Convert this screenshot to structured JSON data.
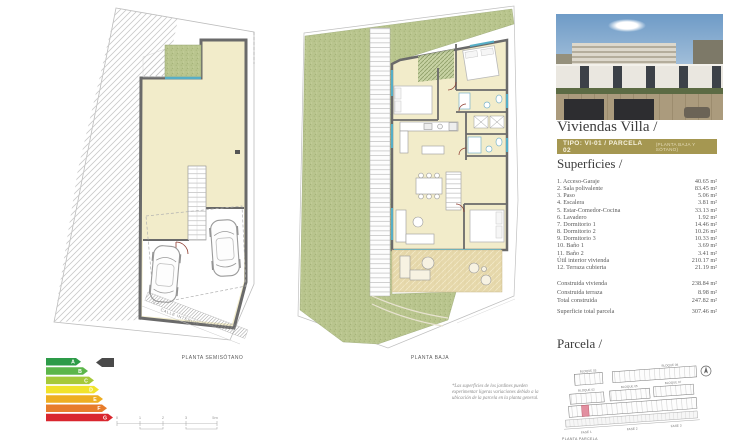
{
  "colors": {
    "banner_gold": "#a59751",
    "floor_cream": "#f2ecca",
    "garden_green": "#b9c58e",
    "wall_gray": "#6a6a6a",
    "window_blue": "#56aec6",
    "door_red": "#8d3b2f",
    "highlight_pink": "#e28fa0"
  },
  "plans": {
    "left": {
      "label": "PLANTA SEMISÓTANO",
      "street": "CALLE INTERIOR"
    },
    "center": {
      "label": "PLANTA BAJA"
    },
    "footnote": "*Las superficies de los jardines pueden experimentar ligeras variaciones debido a la ubicación de la parcela en la planta general."
  },
  "energy": {
    "ratings": [
      {
        "letter": "A",
        "color": "#2d9b48"
      },
      {
        "letter": "B",
        "color": "#5cb64a"
      },
      {
        "letter": "C",
        "color": "#a5c93a"
      },
      {
        "letter": "D",
        "color": "#f1e32b"
      },
      {
        "letter": "E",
        "color": "#eeae21"
      },
      {
        "letter": "F",
        "color": "#e77c2b"
      },
      {
        "letter": "G",
        "color": "#d9262e"
      }
    ],
    "pointer_color": "#4a4a4a"
  },
  "scalebar": {
    "ticks": [
      "0",
      "1",
      "2",
      "3",
      "5m"
    ]
  },
  "panel": {
    "title": "Viviendas Villa /",
    "banner": {
      "main": "TIPO: VI-01 / PARCELA 02",
      "sub": "(PLANTA BAJA Y SÓTANO)"
    },
    "superficies": {
      "heading": "Superficies /",
      "items": [
        {
          "label": "1. Acceso-Garaje",
          "value": "40.65 m²"
        },
        {
          "label": "2. Sala polivalente",
          "value": "83.45 m²"
        },
        {
          "label": "3. Paso",
          "value": "5.06 m²"
        },
        {
          "label": "4. Escalera",
          "value": "3.81 m²"
        },
        {
          "label": "5. Estar-Comedor-Cocina",
          "value": "33.13 m²"
        },
        {
          "label": "6. Lavadero",
          "value": "1.92 m²"
        },
        {
          "label": "7. Dormitorio 1",
          "value": "14.46 m²"
        },
        {
          "label": "8. Dormitorio 2",
          "value": "10.26 m²"
        },
        {
          "label": "9. Dormitorio 3",
          "value": "10.33 m²"
        },
        {
          "label": "10. Baño 1",
          "value": "3.69 m²"
        },
        {
          "label": "11. Baño 2",
          "value": "3.41 m²"
        },
        {
          "label": "Útil interior vivienda",
          "value": "210.17 m²"
        },
        {
          "label": "12. Terraza cubierta",
          "value": "21.19 m²"
        }
      ],
      "summary": [
        {
          "label": "Construida vivienda",
          "value": "238.84 m²"
        },
        {
          "label": "Construida terraza",
          "value": "8.98 m²"
        },
        {
          "label": "Total construida",
          "value": "247.82 m²"
        }
      ],
      "total": {
        "label": "Superficie total parcela",
        "value": "307.46 m²"
      }
    },
    "parcela": {
      "heading": "Parcela /",
      "caption": "PLANTA PARCELA",
      "blocks": [
        "BLOQUE 03",
        "BLOQUE 08",
        "BLOQUE 02",
        "BLOQUE 05",
        "BLOQUE 07"
      ],
      "fases": [
        "FASE 1",
        "FASE 2",
        "FASE 3"
      ]
    }
  }
}
